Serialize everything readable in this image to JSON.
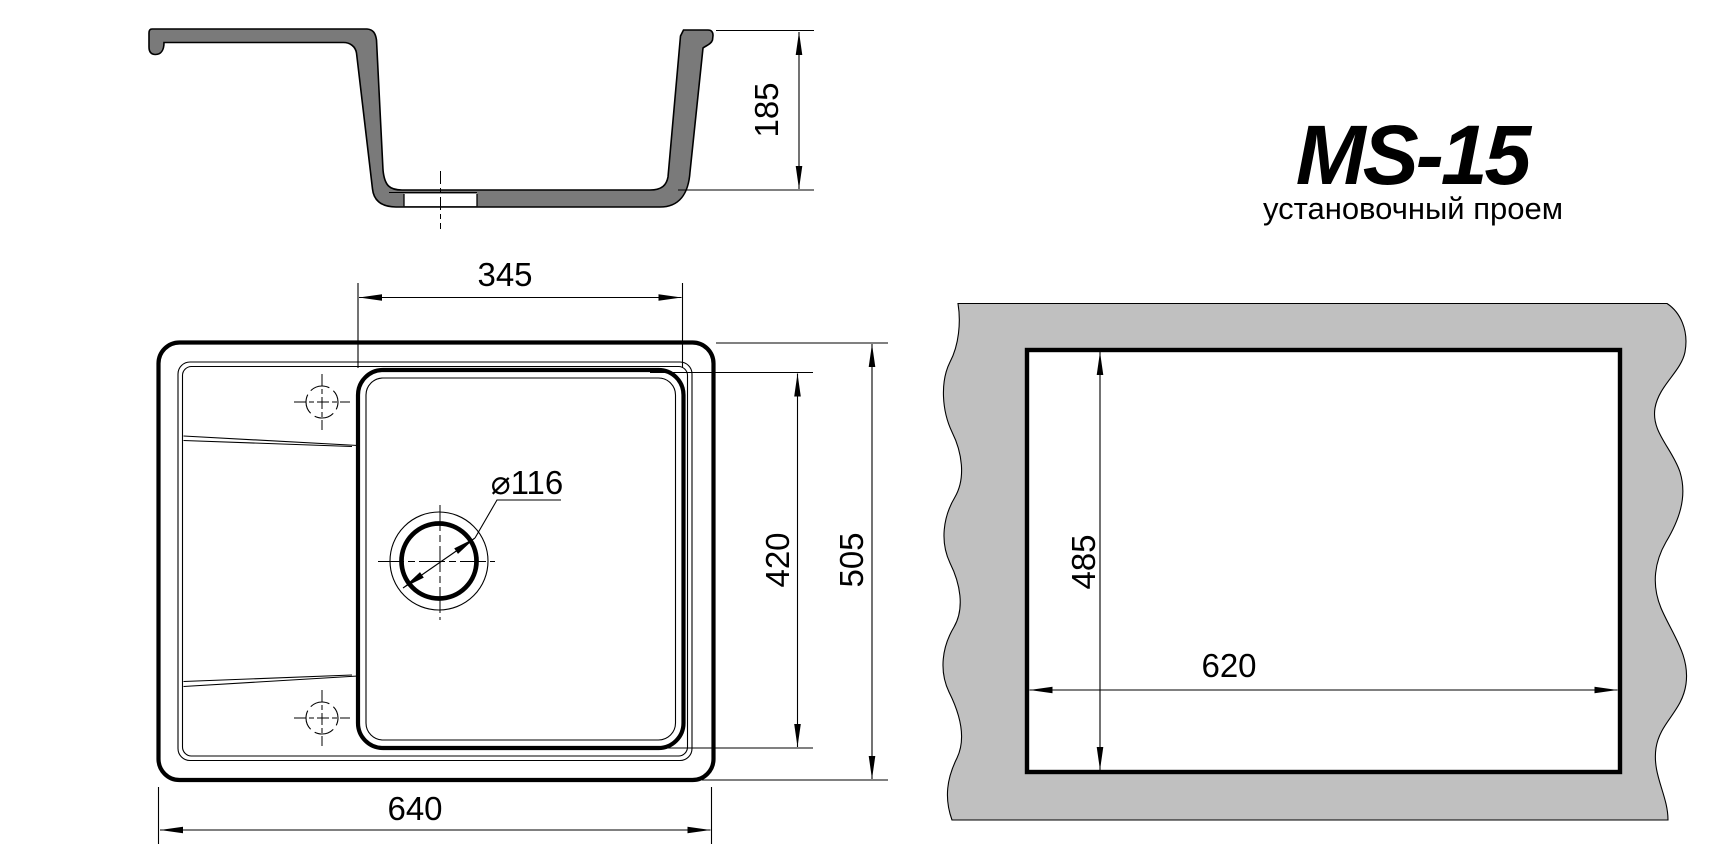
{
  "drawing": {
    "title": "MS-15",
    "subtitle": "установочный проем",
    "section_view": {
      "depth_mm": "185"
    },
    "top_view": {
      "bowl_width_mm": "345",
      "bowl_length_mm": "420",
      "overall_length_mm": "505",
      "overall_width_mm": "640",
      "drain_diameter_mm": "⌀116"
    },
    "cutout_view": {
      "opening_length_mm": "485",
      "opening_width_mm": "620"
    },
    "colors": {
      "line": "#000000",
      "sink_body_gray": "#7a7a7a",
      "countertop_gray": "#c0c0c0",
      "background": "#ffffff"
    }
  }
}
